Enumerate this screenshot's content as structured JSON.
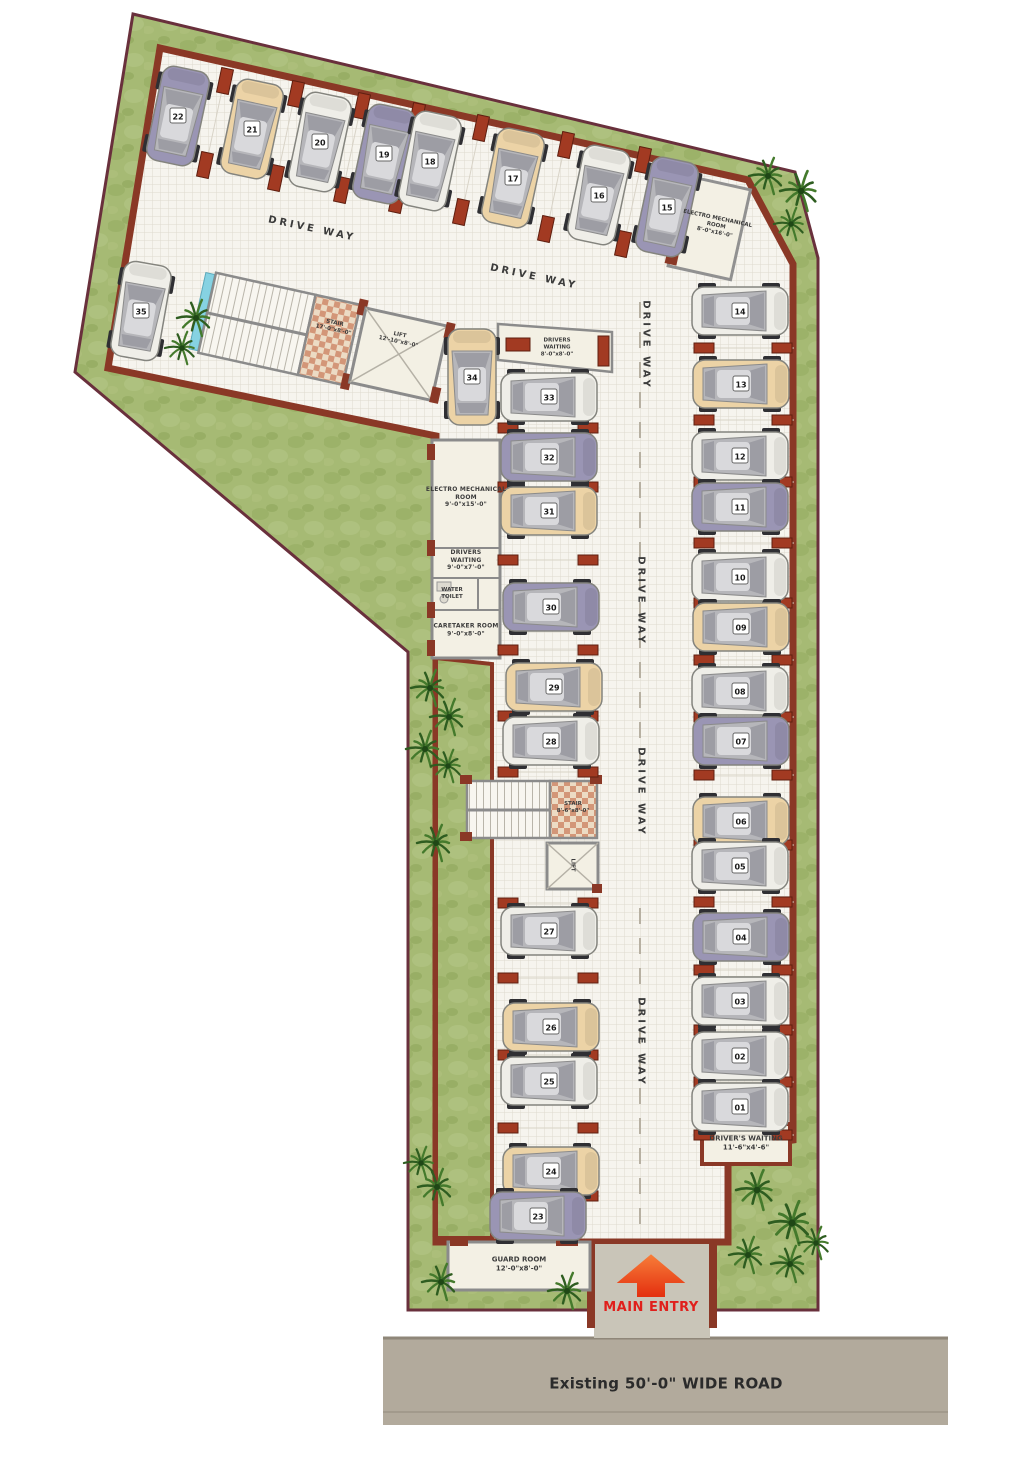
{
  "title": "Parking floor plan",
  "colors": {
    "grass": "#a6ba74",
    "grass_dark": "#8ea75e",
    "boundary": "#69303c",
    "wall": "#8a3826",
    "floor": "#f6f4ee",
    "grid_line": "#dedacf",
    "room": "#f3f0e4",
    "room_wall": "#8b8b8b",
    "brick": "#a23a22",
    "road": "#b2aa9c",
    "entry_arrow": "#ef4a17",
    "entry_text": "#e0201c",
    "car_white": "#efeee8",
    "car_beige": "#ecd3a6",
    "car_violet": "#9a95b4"
  },
  "driveway": {
    "label": "DRIVE WAY",
    "positions": [
      [
        312,
        229,
        12
      ],
      [
        534,
        277,
        12
      ],
      [
        646,
        345,
        90
      ],
      [
        641,
        601,
        90
      ],
      [
        641,
        792,
        90
      ],
      [
        641,
        1042,
        90
      ]
    ]
  },
  "labels": {
    "stair_top": "STAIR\n17'-0\"x8'-0\"",
    "lift_top": "LIFT\n12'-10\"x8'-0\"",
    "electro_mech_top": "ELECTRO MECHANICAL\nROOM\n8'-0\"x16'-0\"",
    "drivers_waiting_top": "DRIVERS\nWAITING\n8'-0\"x8'-0\"",
    "electro_mech_left": "ELECTRO MECHANICAL\nROOM\n9'-0\"x15'-0\"",
    "drivers_waiting_left": "DRIVERS\nWAITING\n9'-0\"x7'-0\"",
    "water_toilet": "WATER\nTOILET",
    "caretaker_room": "CARETAKER ROOM\n9'-0\"x8'-0\"",
    "stair_mid": "STAIR\n8'-6\"x8'-0\"",
    "lift_mid": "LIFT",
    "drivers_waiting_bottom": "DRIVER'S WAITING\n11'-6\"x4'-6\"",
    "guard_room": "GUARD ROOM\n12'-0\"x8'-0\"",
    "main_entry": "MAIN ENTRY",
    "road": "Existing 50'-0\" WIDE ROAD"
  },
  "cars": [
    {
      "no": "22",
      "x": 178,
      "y": 116,
      "r": 12,
      "c": "violet"
    },
    {
      "no": "21",
      "x": 252,
      "y": 129,
      "r": 12,
      "c": "beige"
    },
    {
      "no": "20",
      "x": 320,
      "y": 142,
      "r": 12,
      "c": "white"
    },
    {
      "no": "19",
      "x": 384,
      "y": 154,
      "r": 12,
      "c": "violet"
    },
    {
      "no": "18",
      "x": 430,
      "y": 161,
      "r": 12,
      "c": "white"
    },
    {
      "no": "17",
      "x": 513,
      "y": 178,
      "r": 12,
      "c": "beige"
    },
    {
      "no": "16",
      "x": 599,
      "y": 195,
      "r": 12,
      "c": "white"
    },
    {
      "no": "15",
      "x": 667,
      "y": 207,
      "r": 12,
      "c": "violet"
    },
    {
      "no": "35",
      "x": 141,
      "y": 311,
      "r": 10,
      "c": "white"
    },
    {
      "no": "34",
      "x": 472,
      "y": 377,
      "r": 0,
      "c": "beige"
    },
    {
      "no": "33",
      "x": 549,
      "y": 397,
      "r": 90,
      "c": "white"
    },
    {
      "no": "32",
      "x": 549,
      "y": 457,
      "r": 90,
      "c": "violet"
    },
    {
      "no": "31",
      "x": 549,
      "y": 511,
      "r": 90,
      "c": "beige"
    },
    {
      "no": "30",
      "x": 551,
      "y": 607,
      "r": 90,
      "c": "violet"
    },
    {
      "no": "29",
      "x": 554,
      "y": 687,
      "r": 90,
      "c": "beige"
    },
    {
      "no": "28",
      "x": 551,
      "y": 741,
      "r": 90,
      "c": "white"
    },
    {
      "no": "27",
      "x": 549,
      "y": 931,
      "r": 90,
      "c": "white"
    },
    {
      "no": "26",
      "x": 551,
      "y": 1027,
      "r": 90,
      "c": "beige"
    },
    {
      "no": "25",
      "x": 549,
      "y": 1081,
      "r": 90,
      "c": "white"
    },
    {
      "no": "24",
      "x": 551,
      "y": 1171,
      "r": 90,
      "c": "beige"
    },
    {
      "no": "23",
      "x": 538,
      "y": 1216,
      "r": 90,
      "c": "violet"
    },
    {
      "no": "14",
      "x": 740,
      "y": 311,
      "r": 90,
      "c": "white"
    },
    {
      "no": "13",
      "x": 741,
      "y": 384,
      "r": 90,
      "c": "beige"
    },
    {
      "no": "12",
      "x": 740,
      "y": 456,
      "r": 90,
      "c": "white"
    },
    {
      "no": "11",
      "x": 740,
      "y": 507,
      "r": 90,
      "c": "violet"
    },
    {
      "no": "10",
      "x": 740,
      "y": 577,
      "r": 90,
      "c": "white"
    },
    {
      "no": "09",
      "x": 741,
      "y": 627,
      "r": 90,
      "c": "beige"
    },
    {
      "no": "08",
      "x": 740,
      "y": 691,
      "r": 90,
      "c": "white"
    },
    {
      "no": "07",
      "x": 741,
      "y": 741,
      "r": 90,
      "c": "violet"
    },
    {
      "no": "06",
      "x": 741,
      "y": 821,
      "r": 90,
      "c": "beige"
    },
    {
      "no": "05",
      "x": 740,
      "y": 866,
      "r": 90,
      "c": "white"
    },
    {
      "no": "04",
      "x": 741,
      "y": 937,
      "r": 90,
      "c": "violet"
    },
    {
      "no": "03",
      "x": 740,
      "y": 1001,
      "r": 90,
      "c": "white"
    },
    {
      "no": "02",
      "x": 740,
      "y": 1056,
      "r": 90,
      "c": "white"
    },
    {
      "no": "01",
      "x": 740,
      "y": 1107,
      "r": 90,
      "c": "white"
    }
  ],
  "plants": [
    [
      768,
      176,
      1
    ],
    [
      801,
      191,
      1.1
    ],
    [
      791,
      224,
      0.9
    ],
    [
      196,
      318,
      1
    ],
    [
      182,
      348,
      0.9
    ],
    [
      430,
      688,
      1
    ],
    [
      449,
      717,
      1
    ],
    [
      425,
      749,
      1
    ],
    [
      448,
      766,
      0.9
    ],
    [
      436,
      843,
      1
    ],
    [
      421,
      1163,
      0.9
    ],
    [
      437,
      1187,
      1
    ],
    [
      757,
      1190,
      1.1
    ],
    [
      792,
      1223,
      1.2
    ],
    [
      748,
      1255,
      1
    ],
    [
      790,
      1264,
      1
    ],
    [
      816,
      1243,
      0.9
    ],
    [
      441,
      1282,
      1
    ],
    [
      567,
      1291,
      1
    ]
  ],
  "stalls": {
    "mid": {
      "x1": 500,
      "x2": 596,
      "rows": [
        428,
        487,
        560,
        650,
        716,
        772,
        903,
        978,
        1055,
        1128,
        1196
      ]
    },
    "right": {
      "x1": 696,
      "x2": 790,
      "rows": [
        348,
        420,
        482,
        543,
        603,
        660,
        717,
        775,
        845,
        902,
        970,
        1030,
        1082,
        1135
      ]
    },
    "top": {
      "mids": [
        [
          215,
          123
        ],
        [
          286,
          136
        ],
        [
          352,
          148
        ],
        [
          407,
          158
        ],
        [
          471,
          170
        ],
        [
          556,
          187
        ],
        [
          633,
          202
        ]
      ]
    }
  }
}
